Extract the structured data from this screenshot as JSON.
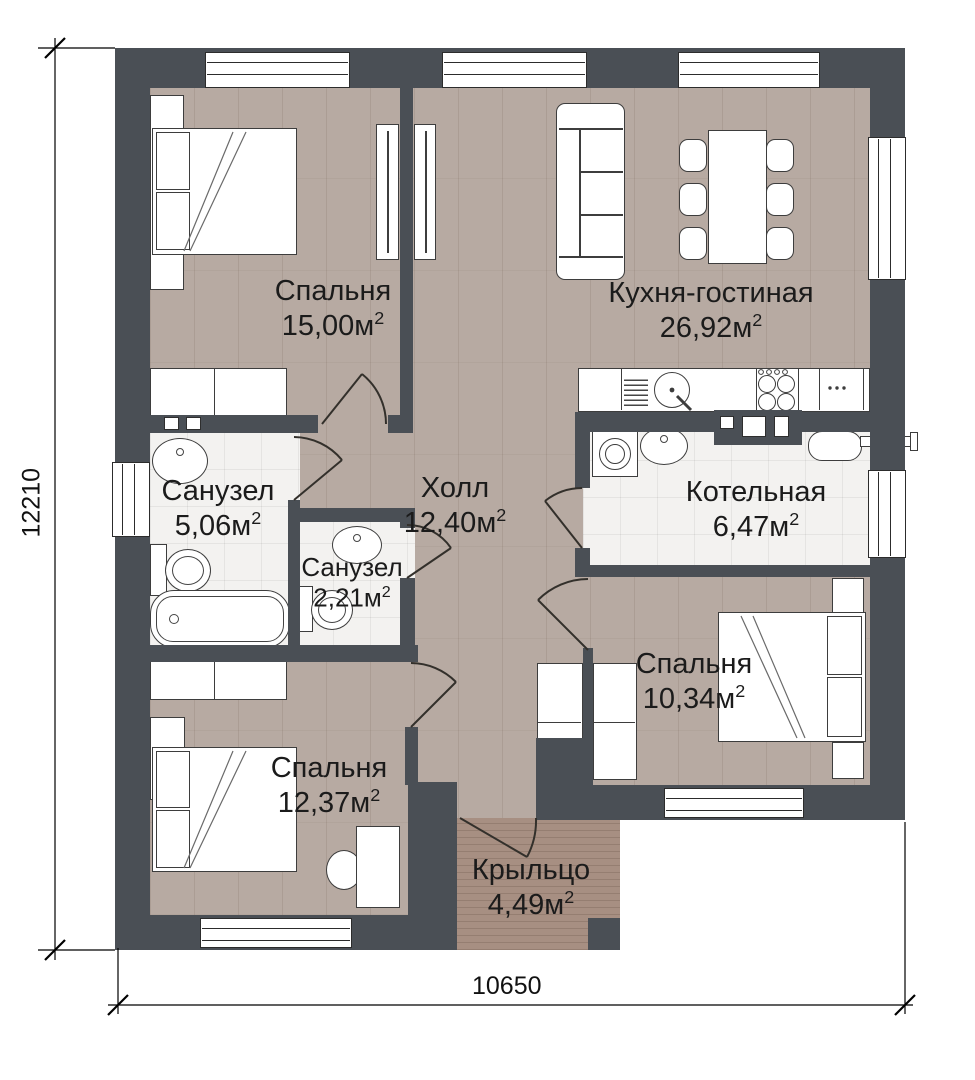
{
  "rooms": {
    "bedroom_15": {
      "name": "Спальня",
      "area": "15,00м",
      "sup": "2"
    },
    "kitchen_living": {
      "name": "Кухня-гостиная",
      "area": "26,92м",
      "sup": "2"
    },
    "bathroom_5": {
      "name": "Санузел",
      "area": "5,06м",
      "sup": "2"
    },
    "hall": {
      "name": "Холл",
      "area": "12,40м",
      "sup": "2"
    },
    "boiler": {
      "name": "Котельная",
      "area": "6,47м",
      "sup": "2"
    },
    "bathroom_2": {
      "name": "Санузел",
      "area": "2,21м",
      "sup": "2"
    },
    "bedroom_10": {
      "name": "Спальня",
      "area": "10,34м",
      "sup": "2"
    },
    "bedroom_12": {
      "name": "Спальня",
      "area": "12,37м",
      "sup": "2"
    },
    "porch": {
      "name": "Крыльцо",
      "area": "4,49м",
      "sup": "2"
    }
  },
  "dimensions": {
    "height": "12210",
    "width": "10650"
  },
  "colors": {
    "wall": "#4a4f55",
    "floor_wood": "#b7aaa2",
    "floor_tile": "#f3f2f0",
    "porch": "#a78f82",
    "furniture_outline": "#3d3d3d"
  }
}
